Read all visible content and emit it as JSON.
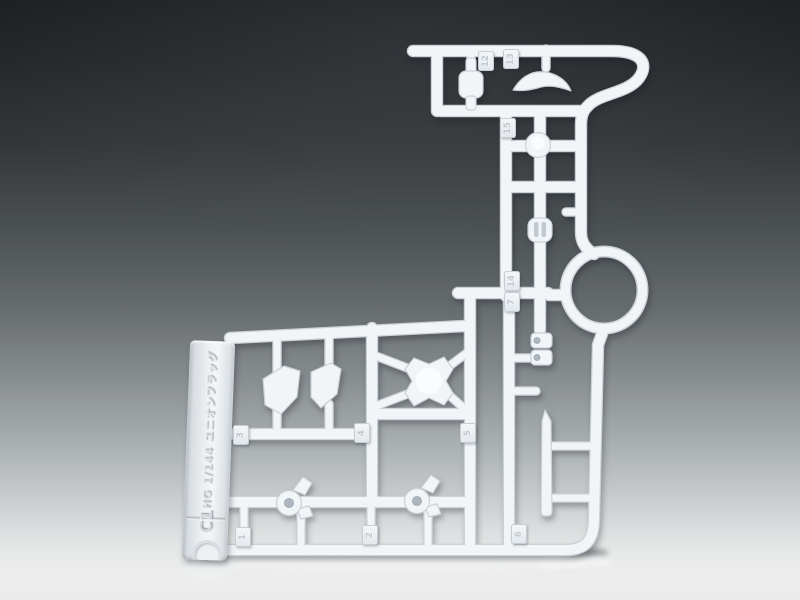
{
  "scene": {
    "type": "product-photo",
    "subject": "White injection-molded plastic model-kit runner (sprue) standing upright on a studio table against a dark-to-light seamless backdrop",
    "backdrop_top_color": "#1d2023",
    "backdrop_bottom_color": "#ecedec",
    "plastic_color": "#f2f5f7",
    "plastic_edge_color": "#c9d0d7"
  },
  "runner": {
    "kit_label": "HG 1/144 ユニオンフラッグ",
    "runner_code": "C1",
    "tags": {
      "t1": "1",
      "t2": "2",
      "t3": "3",
      "t4": "4",
      "t5": "5",
      "t6": "6",
      "t7": "7",
      "t12": "12",
      "t13": "13",
      "t14": "14",
      "t15": "15"
    }
  }
}
